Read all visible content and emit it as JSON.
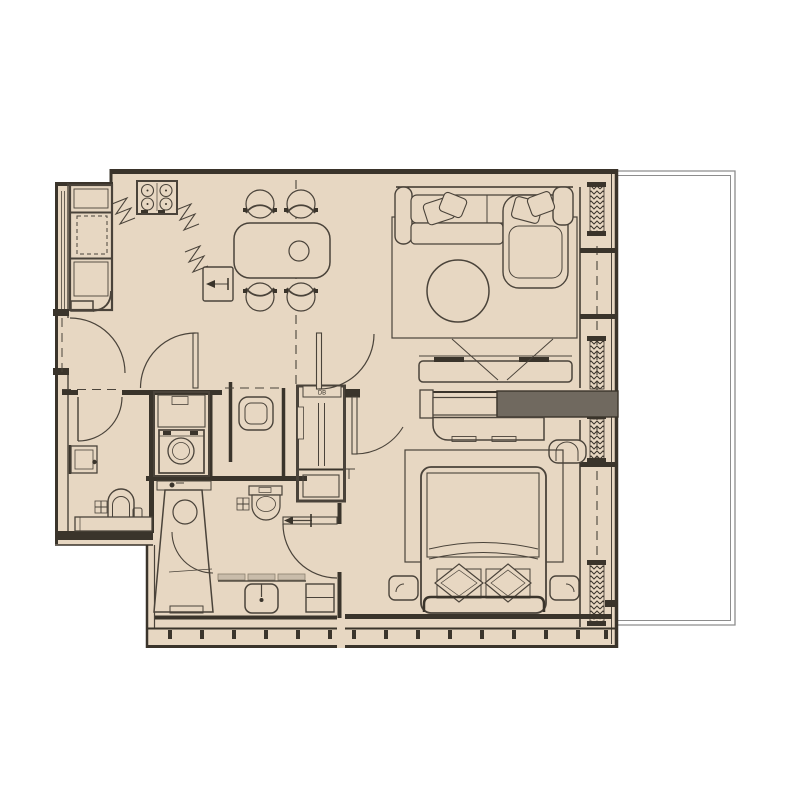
{
  "meta": {
    "title": "Apartment floor plan",
    "drawing_type": "architectural plan view"
  },
  "palette": {
    "background": "#ffffff",
    "floor_fill": "#e7d7c2",
    "wall_dark": "#3a342b",
    "line": "#4a433a",
    "wardrobe_gray": "#70695f",
    "counter_light": "#c9bcaa",
    "balcony_line": "#8d8d8d"
  },
  "labels": {
    "distribution_board": "DB"
  },
  "rooms": [
    {
      "name": "kitchen",
      "furniture": [
        "4-burner stove",
        "tall cabinet column",
        "counter break-lines",
        "dishwasher with arrow"
      ]
    },
    {
      "name": "dining-area",
      "furniture": [
        "rounded dining table",
        "round tray",
        "4 chairs"
      ]
    },
    {
      "name": "living-room",
      "furniture": [
        "corner sofa with chaise",
        "2 pillow sets",
        "round coffee table",
        "rug",
        "tv console",
        "projection lines"
      ]
    },
    {
      "name": "bedroom",
      "furniture": [
        "double bed",
        "2 diamond pillows",
        "2 nightstands",
        "rug",
        "dresser",
        "armchair",
        "gray wardrobe bar",
        "headboard"
      ]
    },
    {
      "name": "master-bathroom",
      "furniture": [
        "shower stall",
        "toilet",
        "vanity sink",
        "drawer cabinet",
        "floor drain"
      ]
    },
    {
      "name": "guest-bathroom",
      "furniture": [
        "toilet",
        "wall sink",
        "shelf",
        "floor drain",
        "bottle"
      ]
    },
    {
      "name": "laundry-closet",
      "furniture": [
        "washing machine",
        "upper shelf"
      ]
    },
    {
      "name": "hallway",
      "furniture": [
        "side table",
        "wardrobe closet with rail",
        "DB box",
        "T mark"
      ]
    },
    {
      "name": "entry",
      "furniture": [
        "door swing arcs"
      ]
    },
    {
      "name": "balcony",
      "furniture": []
    }
  ],
  "annotations": {
    "door_swings": 8,
    "glazed_wall_side": "right",
    "insulation_hatch_blocks": 4,
    "dashed_zone_lines": 3
  }
}
